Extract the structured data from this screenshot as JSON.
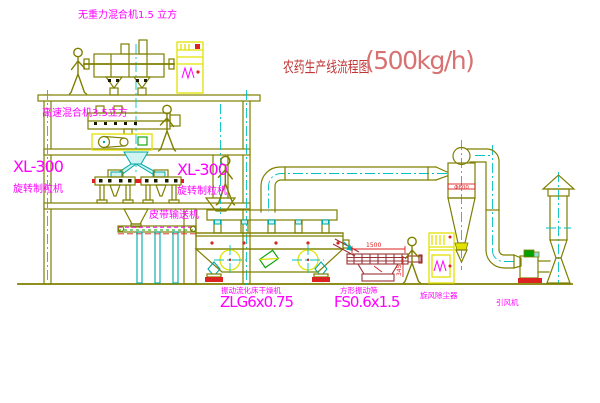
{
  "title": {
    "name": "农药生产线流程图",
    "capacity": "(500kg/h)"
  },
  "labels": {
    "gravity_mixer": "无重力混合机1.5 立方",
    "high_speed_mixer": "高速混合机3.5立方",
    "granulator_left_model": "XL-300",
    "granulator_left_name": "旋转制粒机",
    "granulator_right_model": "XL-300",
    "granulator_right_name": "旋转制粒机",
    "belt_conveyor": "皮带输送机",
    "fluid_bed_dryer_name": "振动流化床干燥机",
    "fluid_bed_dryer_model": "ZLG6x0.75",
    "square_sieve_name": "方形振动筛",
    "square_sieve_model": "FS0.6x1.5",
    "cyclone": "旋风除尘器",
    "induced_draft_fan": "引风机"
  },
  "dimensions": {
    "cyclone_diameter": "Φ600",
    "sieve_length": "1500",
    "sieve_height": "345"
  },
  "colors": {
    "structure": "#7f7f00",
    "centerline": "#00c2c2",
    "label_magenta": "#ff00ff",
    "title_red": "#c03535",
    "capacity_red": "#d87272",
    "cabinet_yellow": "#e2e200",
    "sieve_maroon": "#993333",
    "accent_red": "#dd2222",
    "accent_green": "#00a000"
  }
}
